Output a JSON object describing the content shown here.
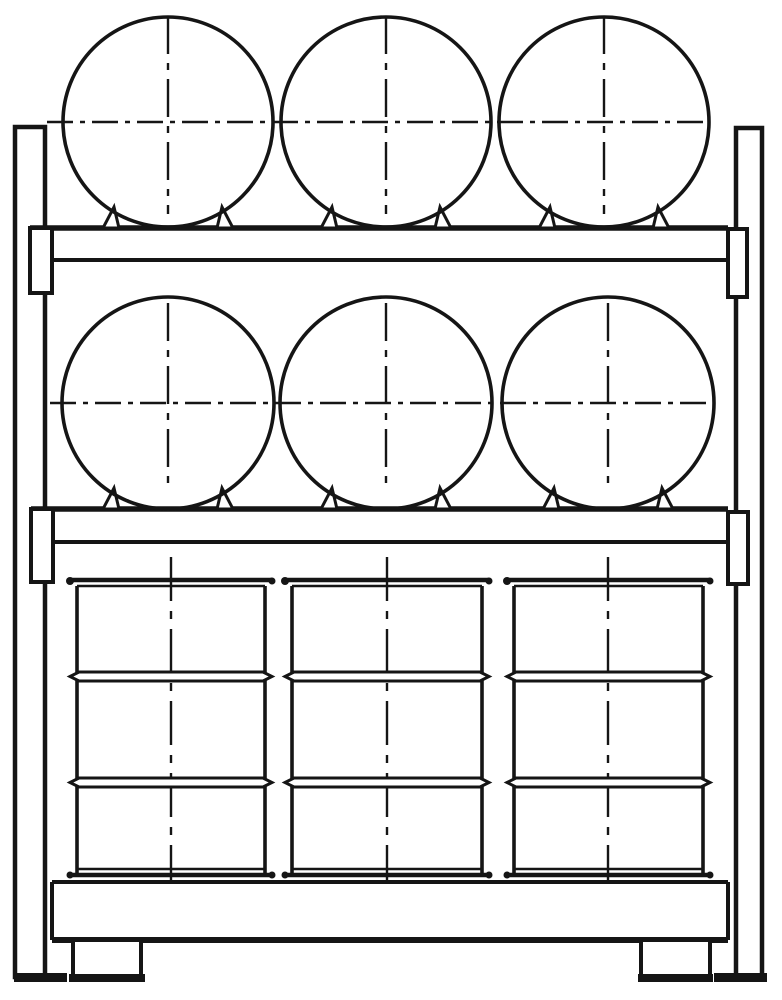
{
  "figure": {
    "subject": "drum storage rack front elevation line drawing",
    "canvas": {
      "width": 782,
      "height": 1000
    },
    "paper_color": "#ffffff",
    "ink_color": "#151515",
    "counts": {
      "shelf_levels": 3,
      "horizontal_drums": 6,
      "upright_drums": 3,
      "drums_per_level": 3
    }
  },
  "frame": {
    "posts": [
      {
        "id": "left-post",
        "x": 15,
        "y": 127,
        "w": 30,
        "h": 850,
        "foot": {
          "x": 14,
          "y": 973,
          "w": 53,
          "h": 9
        }
      },
      {
        "id": "right-post",
        "x": 736,
        "y": 128,
        "w": 26,
        "h": 849,
        "foot": {
          "x": 714,
          "y": 973,
          "w": 53,
          "h": 9
        }
      }
    ],
    "beams": [
      {
        "id": "upper-shelf-beam",
        "y_top": 228,
        "x1": 30,
        "x2": 728,
        "y_bot": 260,
        "bx1": 52,
        "bx2": 728
      },
      {
        "id": "middle-shelf-beam",
        "y_top": 509,
        "x1": 31,
        "x2": 728,
        "y_bot": 542,
        "bx1": 53,
        "bx2": 728
      }
    ],
    "brackets": [
      {
        "id": "upper-beam-left-bracket",
        "x": 30,
        "y": 228,
        "w": 22,
        "h": 65
      },
      {
        "id": "upper-beam-right-bracket",
        "x": 728,
        "y": 229,
        "w": 19,
        "h": 68
      },
      {
        "id": "middle-beam-left-bracket",
        "x": 31,
        "y": 509,
        "w": 22,
        "h": 73
      },
      {
        "id": "middle-beam-right-bracket",
        "x": 728,
        "y": 512,
        "w": 20,
        "h": 72
      }
    ],
    "base": {
      "x1": 52,
      "x2": 728,
      "y_top": 882,
      "y_bot": 940,
      "feet": [
        {
          "id": "left-base-foot",
          "x": 73,
          "y": 940,
          "w": 68,
          "h": 36,
          "bar": {
            "x": 69,
            "y": 974,
            "w": 76,
            "h": 8
          }
        },
        {
          "id": "right-base-foot",
          "x": 641,
          "y": 940,
          "w": 69,
          "h": 36,
          "bar": {
            "x": 638,
            "y": 974,
            "w": 75,
            "h": 8
          }
        }
      ]
    }
  },
  "horizontal_drum_rows": [
    {
      "id": "top-row",
      "cy": 122,
      "r": 105,
      "centers_x": [
        168,
        386,
        604
      ],
      "support_y": 228,
      "axis_h": {
        "y": 122,
        "x1": 47,
        "x2": 709
      },
      "axis_v": {
        "y1": 16,
        "y2": 214
      }
    },
    {
      "id": "middle-row",
      "cy": 403,
      "r": 106,
      "centers_x": [
        168,
        386,
        608
      ],
      "support_y": 509,
      "axis_h": {
        "y": 403,
        "x1": 50,
        "x2": 707
      },
      "axis_v": {
        "y1": 303,
        "y2": 484
      }
    }
  ],
  "chock": {
    "outer_dx": 65,
    "inner_dx": 49,
    "apex_dx": 54,
    "height": 21
  },
  "vertical_drums": {
    "cap_top_y": 580,
    "cap_top2_y": 586,
    "body_top": 586,
    "body_bot": 876,
    "cap_bot_thin_y": 869,
    "cap_bot_y": 875,
    "overhang": 7,
    "rib_ys": [
      672,
      778
    ],
    "rib_h": 9,
    "rib_point": 7,
    "axis_v": {
      "y1": 557,
      "y2": 880
    },
    "drums": [
      {
        "id": "upright-drum-1",
        "x1": 77,
        "x2": 265,
        "cx": 171
      },
      {
        "id": "upright-drum-2",
        "x1": 292,
        "x2": 482,
        "cx": 387
      },
      {
        "id": "upright-drum-3",
        "x1": 514,
        "x2": 703,
        "cx": 608
      }
    ]
  },
  "strokes": {
    "main": 4,
    "heavy": 6,
    "beam_top": 5.5,
    "circle": 3.6,
    "thin": 2.5,
    "axis": 2.4,
    "dash_h": "26 7 5 7",
    "dash_v": "38 9 7 9",
    "dash_drum": "44 10 8 10"
  }
}
